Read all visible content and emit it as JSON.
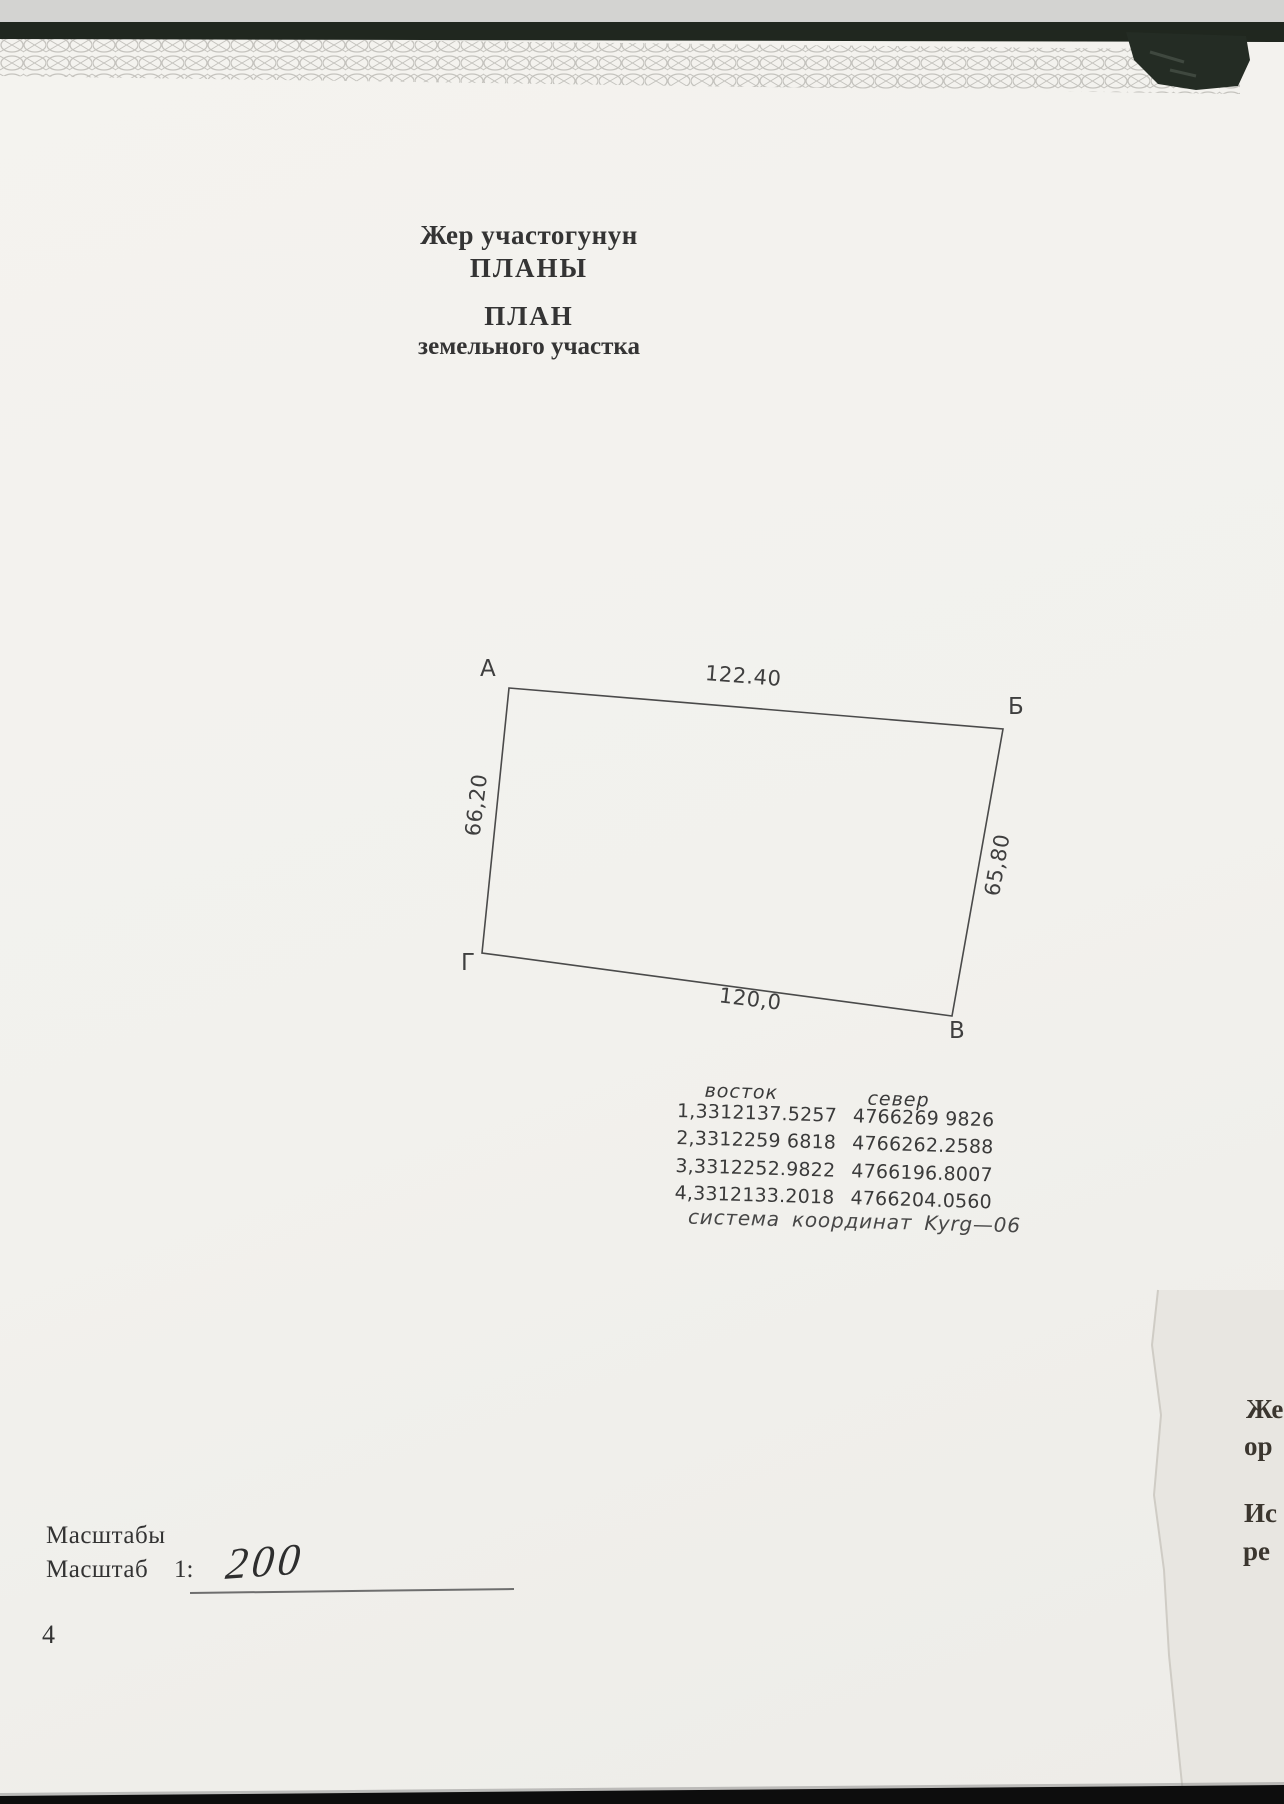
{
  "document": {
    "header": {
      "line1": "Жер участогунун",
      "line2": "ПЛАНЫ",
      "line3": "ПЛАН",
      "line4": "земельного участка"
    },
    "page_number": "4"
  },
  "parcel": {
    "corner_labels": {
      "a": "А",
      "b": "Б",
      "v": "В",
      "g": "Г"
    },
    "side_lengths": {
      "top": "122.40",
      "left": "66,20",
      "right": "65,80",
      "bottom": "120,0"
    }
  },
  "coordinates": {
    "header_east": "восток",
    "header_north": "север",
    "rows": [
      {
        "east": "1,3312137.5257",
        "north": "4766269 9826"
      },
      {
        "east": "2,3312259 6818",
        "north": "4766262.2588"
      },
      {
        "east": "3,3312252.9822",
        "north": "4766196.8007"
      },
      {
        "east": "4,3312133.2018",
        "north": "4766204.0560"
      }
    ],
    "system_note": "система координат Kyrg—06"
  },
  "scale": {
    "heading": "Масштабы",
    "label": "Масштаб",
    "ratio_prefix": "1:",
    "handwritten_value": "200"
  },
  "adjacent_sheet": {
    "fragments": [
      "Же",
      "ор",
      "Ис",
      "ре"
    ]
  },
  "colors": {
    "paper": "#f2f1ed",
    "adjacent_paper": "#e8e6e1",
    "ink": "#343434",
    "diagram_line": "#4a4a4a",
    "scan_band": "#20271f",
    "bottom_bar": "#0d0d0d",
    "guilloche": "#9e9c96"
  }
}
